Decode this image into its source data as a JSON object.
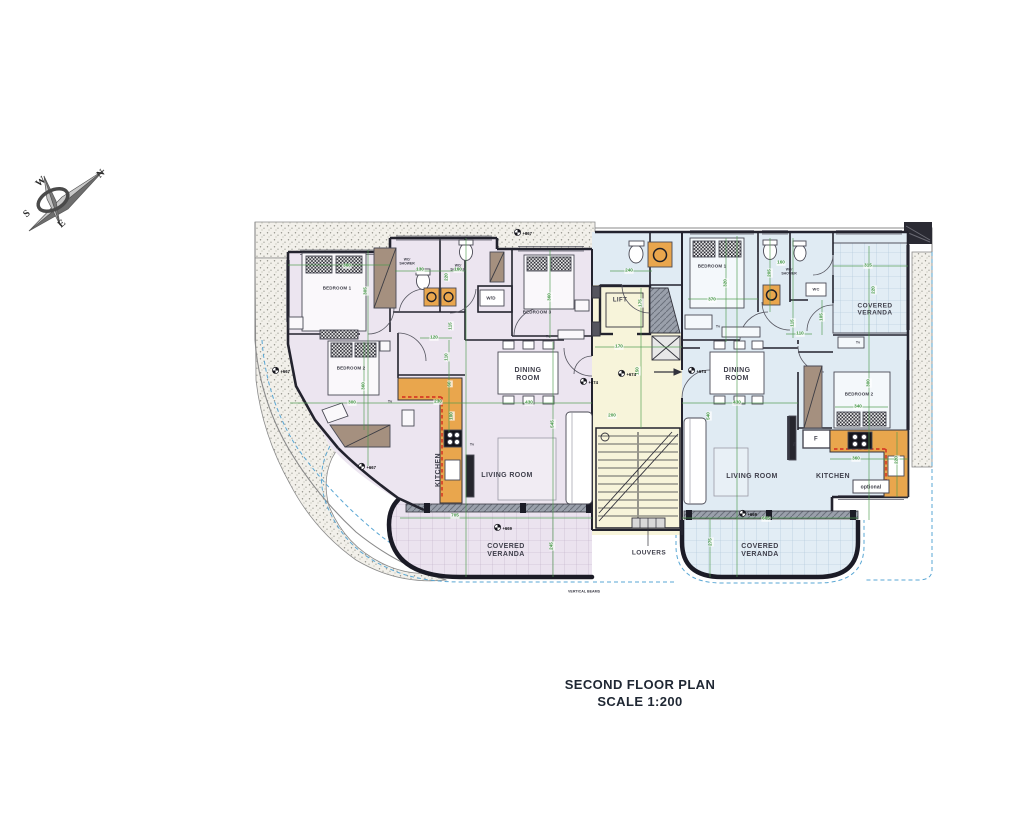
{
  "title": {
    "line1": "SECOND FLOOR PLAN",
    "line2": "SCALE 1:200"
  },
  "colors": {
    "dim-green": "#3f9440",
    "wall-ink": "#23232e",
    "left-apartment-fill": "#ece5f0",
    "right-apartment-fill": "#e0ebf3",
    "core-fill": "#f7f4da",
    "counter-orange": "#e9a64d",
    "wardrobe-brown": "#a5907f",
    "dashed-blue": "#5aa7d4",
    "title-ink": "#1f2733"
  },
  "compass": {
    "n": "N",
    "w": "W",
    "s": "S",
    "e": "E"
  },
  "plan_labels": [
    {
      "t": "N",
      "x": 101,
      "y": 174,
      "s": 10,
      "r": -42,
      "c": "compass",
      "n": "compass-letter-n"
    },
    {
      "t": "W",
      "x": 41,
      "y": 182,
      "s": 10,
      "r": -42,
      "c": "compass",
      "n": "compass-letter-w"
    },
    {
      "t": "S",
      "x": 27,
      "y": 214,
      "s": 10,
      "r": -42,
      "c": "compass",
      "n": "compass-letter-s"
    },
    {
      "t": "E",
      "x": 62,
      "y": 224,
      "s": 10,
      "r": -42,
      "c": "compass",
      "n": "compass-letter-e"
    },
    {
      "t": "BEDROOM 1",
      "x": 337,
      "y": 289,
      "s": 4.5,
      "c": "room",
      "n": "room-label-bedroom1-left"
    },
    {
      "t": "BEDROOM 2",
      "x": 351,
      "y": 369,
      "s": 4.5,
      "c": "room",
      "n": "room-label-bedroom2-left"
    },
    {
      "t": "BEDROOM 3",
      "x": 537,
      "y": 313,
      "s": 4.5,
      "c": "room",
      "n": "room-label-bedroom3-left"
    },
    {
      "t": "DINING\nROOM",
      "x": 528,
      "y": 375,
      "s": 7,
      "c": "big",
      "n": "room-label-dining-left"
    },
    {
      "t": "LIVING ROOM",
      "x": 507,
      "y": 476,
      "s": 7,
      "c": "big",
      "n": "room-label-living-left"
    },
    {
      "t": "KITCHEN",
      "x": 439,
      "y": 470,
      "s": 7,
      "r": -90,
      "c": "big",
      "n": "room-label-kitchen-left"
    },
    {
      "t": "COVERED\nVERANDA",
      "x": 506,
      "y": 551,
      "s": 7,
      "c": "big",
      "n": "room-label-veranda-left"
    },
    {
      "t": "WC/\nSHOWER",
      "x": 407,
      "y": 262,
      "s": 3.4,
      "c": "tiny",
      "n": "room-label-wc-shower-1-left"
    },
    {
      "t": "WC/\nSHOWER",
      "x": 458,
      "y": 268,
      "s": 3.4,
      "c": "tiny",
      "n": "room-label-wc-shower-2-left"
    },
    {
      "t": "W/D",
      "x": 491,
      "y": 299,
      "s": 4.5,
      "c": "room",
      "n": "label-washer-dryer"
    },
    {
      "t": "LIFT",
      "x": 620,
      "y": 301,
      "s": 6,
      "c": "big",
      "n": "label-lift"
    },
    {
      "t": "LOUVERS",
      "x": 649,
      "y": 553,
      "s": 6.5,
      "c": "big",
      "n": "label-louvers"
    },
    {
      "t": "VERTICAL BEAMS",
      "x": 584,
      "y": 592,
      "s": 3.6,
      "c": "tiny",
      "n": "label-vertical-beams"
    },
    {
      "t": "BEDROOM 1",
      "x": 712,
      "y": 267,
      "s": 4.5,
      "c": "room",
      "n": "room-label-bedroom1-right"
    },
    {
      "t": "WC/\nSHOWER",
      "x": 789,
      "y": 272,
      "s": 3.4,
      "c": "tiny",
      "n": "room-label-wc-shower-right"
    },
    {
      "t": "WC",
      "x": 816,
      "y": 290,
      "s": 4,
      "c": "room",
      "n": "room-label-wc-right"
    },
    {
      "t": "COVERED\nVERANDA",
      "x": 875,
      "y": 310,
      "s": 6.5,
      "c": "big",
      "n": "room-label-veranda-top-right"
    },
    {
      "t": "DINING\nROOM",
      "x": 737,
      "y": 375,
      "s": 7,
      "c": "big",
      "n": "room-label-dining-right"
    },
    {
      "t": "BEDROOM 2",
      "x": 859,
      "y": 395,
      "s": 4.5,
      "c": "room",
      "n": "room-label-bedroom2-right"
    },
    {
      "t": "LIVING ROOM",
      "x": 752,
      "y": 477,
      "s": 7,
      "c": "big",
      "n": "room-label-living-right"
    },
    {
      "t": "KITCHEN",
      "x": 833,
      "y": 477,
      "s": 7,
      "c": "big",
      "n": "room-label-kitchen-right"
    },
    {
      "t": "optional",
      "x": 871,
      "y": 488,
      "s": 5,
      "c": "room",
      "n": "label-optional"
    },
    {
      "t": "F",
      "x": 816,
      "y": 440,
      "s": 6,
      "c": "big",
      "n": "label-fridge"
    },
    {
      "t": "COVERED\nVERANDA",
      "x": 760,
      "y": 551,
      "s": 7,
      "c": "big",
      "n": "room-label-veranda-bottom-right"
    },
    {
      "t": "Tv",
      "x": 334,
      "y": 332,
      "s": 3.6,
      "c": "tiny",
      "n": "label-tv-bedroom1-left"
    },
    {
      "t": "Tv",
      "x": 390,
      "y": 402,
      "s": 3.6,
      "c": "tiny",
      "n": "label-tv-bedroom2-left"
    },
    {
      "t": "Tv",
      "x": 548,
      "y": 337,
      "s": 3.6,
      "c": "tiny",
      "n": "label-tv-bedroom3-left"
    },
    {
      "t": "Tv",
      "x": 472,
      "y": 445,
      "s": 3.6,
      "c": "tiny",
      "n": "label-tv-living-left"
    },
    {
      "t": "Tv",
      "x": 718,
      "y": 327,
      "s": 3.6,
      "c": "tiny",
      "n": "label-tv-bedroom1-right"
    },
    {
      "t": "Tv",
      "x": 858,
      "y": 343,
      "s": 3.6,
      "c": "tiny",
      "n": "label-tv-bedroom2-right"
    },
    {
      "t": "Tv",
      "x": 795,
      "y": 444,
      "s": 3.6,
      "r": -90,
      "c": "tiny",
      "n": "label-tv-living-right"
    },
    {
      "t": "360",
      "x": 347,
      "y": 266,
      "s": 4.6,
      "c": "dim",
      "n": "dim-bedroom1-left-width"
    },
    {
      "t": "305",
      "x": 366,
      "y": 291,
      "s": 4.6,
      "r": -90,
      "c": "dim",
      "n": "dim-bedroom1-left-depth"
    },
    {
      "t": "130",
      "x": 420,
      "y": 270,
      "s": 4.6,
      "c": "dim",
      "n": "dim-wc1-width"
    },
    {
      "t": "160",
      "x": 458,
      "y": 270,
      "s": 4.6,
      "c": "dim",
      "n": "dim-wc2-width"
    },
    {
      "t": "220",
      "x": 447,
      "y": 277,
      "s": 4.6,
      "r": -90,
      "c": "dim",
      "n": "dim-wc-depth"
    },
    {
      "t": "115",
      "x": 451,
      "y": 326,
      "s": 4.6,
      "r": -90,
      "c": "dim",
      "n": "dim-hall-left"
    },
    {
      "t": "120",
      "x": 434,
      "y": 338,
      "s": 4.6,
      "c": "dim",
      "n": "dim-hall-left-2"
    },
    {
      "t": "360",
      "x": 550,
      "y": 297,
      "s": 4.6,
      "r": -90,
      "c": "dim",
      "n": "dim-bedroom3-left"
    },
    {
      "t": "300",
      "x": 352,
      "y": 403,
      "s": 4.6,
      "c": "dim",
      "n": "dim-bedroom2-left-width"
    },
    {
      "t": "360",
      "x": 364,
      "y": 386,
      "s": 4.6,
      "r": -90,
      "c": "dim",
      "n": "dim-bedroom2-left-depth"
    },
    {
      "t": "110",
      "x": 447,
      "y": 357,
      "s": 4.6,
      "r": -90,
      "c": "dim",
      "n": "dim-kitchen-left-1"
    },
    {
      "t": "60",
      "x": 450,
      "y": 384,
      "s": 4.6,
      "r": -90,
      "c": "dim",
      "n": "dim-kitchen-left-2"
    },
    {
      "t": "230",
      "x": 438,
      "y": 402,
      "s": 4.6,
      "c": "dim",
      "n": "dim-kitchen-left-3"
    },
    {
      "t": "100",
      "x": 452,
      "y": 416,
      "s": 4.6,
      "r": -90,
      "c": "dim",
      "n": "dim-kitchen-left-4"
    },
    {
      "t": "430",
      "x": 529,
      "y": 403,
      "s": 4.6,
      "c": "dim",
      "n": "dim-dining-left-width"
    },
    {
      "t": "545",
      "x": 553,
      "y": 424,
      "s": 4.6,
      "r": -90,
      "c": "dim",
      "n": "dim-living-left-depth"
    },
    {
      "t": "705",
      "x": 455,
      "y": 516,
      "s": 4.6,
      "c": "dim",
      "n": "dim-veranda-left-width"
    },
    {
      "t": "245",
      "x": 552,
      "y": 546,
      "s": 4.6,
      "r": -90,
      "c": "dim",
      "n": "dim-veranda-left-depth"
    },
    {
      "t": "170",
      "x": 619,
      "y": 347,
      "s": 4.6,
      "c": "dim",
      "n": "dim-corridor-width"
    },
    {
      "t": "175",
      "x": 641,
      "y": 303,
      "s": 4.6,
      "r": -90,
      "c": "dim",
      "n": "dim-lift-depth"
    },
    {
      "t": "150",
      "x": 638,
      "y": 371,
      "s": 4.6,
      "r": -90,
      "c": "dim",
      "n": "dim-corridor-depth"
    },
    {
      "t": "200",
      "x": 612,
      "y": 416,
      "s": 4.6,
      "c": "dim",
      "n": "dim-stair-width"
    },
    {
      "t": "240",
      "x": 629,
      "y": 271,
      "s": 4.6,
      "c": "dim",
      "n": "dim-bath-entry-right"
    },
    {
      "t": "370",
      "x": 712,
      "y": 300,
      "s": 4.6,
      "c": "dim",
      "n": "dim-bedroom1-right-width"
    },
    {
      "t": "320",
      "x": 726,
      "y": 283,
      "s": 4.6,
      "r": -90,
      "c": "dim",
      "n": "dim-bedroom1-right-depth"
    },
    {
      "t": "160",
      "x": 781,
      "y": 263,
      "s": 4.6,
      "c": "dim",
      "n": "dim-wc-shower-right-width"
    },
    {
      "t": "205",
      "x": 770,
      "y": 273,
      "s": 4.6,
      "r": -90,
      "c": "dim",
      "n": "dim-wc-shower-right-depth"
    },
    {
      "t": "115",
      "x": 793,
      "y": 323,
      "s": 4.6,
      "r": -90,
      "c": "dim",
      "n": "dim-hall-right-1"
    },
    {
      "t": "110",
      "x": 800,
      "y": 334,
      "s": 4.6,
      "c": "dim",
      "n": "dim-hall-right-2"
    },
    {
      "t": "315",
      "x": 868,
      "y": 266,
      "s": 4.6,
      "c": "dim",
      "n": "dim-veranda-top-right-width"
    },
    {
      "t": "220",
      "x": 874,
      "y": 290,
      "s": 4.6,
      "r": -90,
      "c": "dim",
      "n": "dim-veranda-top-right-depth"
    },
    {
      "t": "105",
      "x": 822,
      "y": 317,
      "s": 4.6,
      "r": -90,
      "c": "dim",
      "n": "dim-wc-right-depth"
    },
    {
      "t": "430",
      "x": 737,
      "y": 403,
      "s": 4.6,
      "c": "dim",
      "n": "dim-dining-right-width"
    },
    {
      "t": "540",
      "x": 709,
      "y": 416,
      "s": 4.6,
      "r": -90,
      "c": "dim",
      "n": "dim-living-right-depth"
    },
    {
      "t": "300",
      "x": 869,
      "y": 383,
      "s": 4.6,
      "r": -90,
      "c": "dim",
      "n": "dim-bedroom2-right-depth"
    },
    {
      "t": "340",
      "x": 858,
      "y": 407,
      "s": 4.6,
      "c": "dim",
      "n": "dim-bedroom2-right-width"
    },
    {
      "t": "360",
      "x": 856,
      "y": 459,
      "s": 4.6,
      "c": "dim",
      "n": "dim-kitchen-right-width"
    },
    {
      "t": "220",
      "x": 897,
      "y": 460,
      "s": 4.6,
      "r": -90,
      "c": "dim",
      "n": "dim-kitchen-right-depth"
    },
    {
      "t": "605",
      "x": 766,
      "y": 519,
      "s": 4.6,
      "c": "dim",
      "n": "dim-veranda-right-width"
    },
    {
      "t": "275",
      "x": 711,
      "y": 542,
      "s": 4.6,
      "r": -90,
      "c": "dim",
      "n": "dim-veranda-right-depth"
    },
    {
      "t": "+667",
      "x": 523,
      "y": 233,
      "s": 4.2,
      "c": "lvl",
      "n": "level-marker-667-top"
    },
    {
      "t": "+667",
      "x": 281,
      "y": 371,
      "s": 4.2,
      "c": "lvl",
      "n": "level-marker-667-left"
    },
    {
      "t": "+667",
      "x": 367,
      "y": 467,
      "s": 4.2,
      "c": "lvl",
      "n": "level-marker-667-lower"
    },
    {
      "t": "+674",
      "x": 589,
      "y": 382,
      "s": 4.2,
      "c": "lvl",
      "n": "level-marker-674-dining-left"
    },
    {
      "t": "+674",
      "x": 627,
      "y": 374,
      "s": 4.2,
      "c": "lvl",
      "n": "level-marker-674-corridor"
    },
    {
      "t": "+674",
      "x": 697,
      "y": 371,
      "s": 4.2,
      "c": "lvl",
      "n": "level-marker-674-dining-right"
    },
    {
      "t": "+669",
      "x": 503,
      "y": 528,
      "s": 4.2,
      "c": "lvl",
      "n": "level-marker-669-veranda-left"
    },
    {
      "t": "+669",
      "x": 748,
      "y": 514,
      "s": 4.2,
      "c": "lvl",
      "n": "level-marker-669-veranda-right"
    }
  ]
}
